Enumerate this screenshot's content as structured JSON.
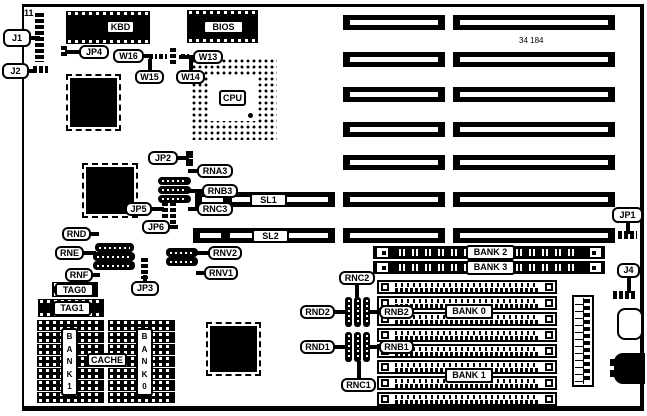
{
  "title": "motherboard jumper location diagram",
  "part_number": "34 184",
  "pin1_label": "11",
  "cpu_label": "CPU",
  "board": {
    "x": 22,
    "y": 4,
    "w": 622,
    "h": 407
  },
  "texts": [
    {
      "label": "11",
      "x": 24,
      "y": 8,
      "style": "bold"
    },
    {
      "label": "34 184",
      "x": 519,
      "y": 36,
      "style": "small"
    }
  ],
  "labels": [
    {
      "label": "KBD",
      "x": 106,
      "y": 20,
      "w": 29,
      "h": 14
    },
    {
      "label": "BIOS",
      "x": 203,
      "y": 20,
      "w": 41,
      "h": 14
    },
    {
      "label": "CPU",
      "x": 219,
      "y": 90,
      "w": 27,
      "h": 16
    },
    {
      "label": "SL1",
      "x": 250,
      "y": 193,
      "w": 37,
      "h": 14
    },
    {
      "label": "SL2",
      "x": 252,
      "y": 229,
      "w": 37,
      "h": 14
    },
    {
      "label": "TAG0",
      "x": 55,
      "y": 283,
      "w": 39,
      "h": 14
    },
    {
      "label": "TAG1",
      "x": 53,
      "y": 301,
      "w": 38,
      "h": 15
    },
    {
      "label": "CACHE",
      "x": 87,
      "y": 353,
      "w": 40,
      "h": 14
    },
    {
      "label": "BANK 2",
      "x": 466,
      "y": 245,
      "w": 49,
      "h": 15
    },
    {
      "label": "BANK 3",
      "x": 466,
      "y": 260,
      "w": 49,
      "h": 15
    },
    {
      "label": "BANK 0",
      "x": 445,
      "y": 304,
      "w": 48,
      "h": 15
    },
    {
      "label": "BANK 1",
      "x": 445,
      "y": 368,
      "w": 48,
      "h": 15
    }
  ],
  "vertical_labels": [
    {
      "label": "B\nA\nN\nK\n1",
      "x": 61,
      "y": 328,
      "w": 17,
      "h": 68
    },
    {
      "label": "B\nA\nN\nK\n0",
      "x": 136,
      "y": 328,
      "w": 17,
      "h": 68
    }
  ],
  "callouts": [
    {
      "label": "J1",
      "x": 3,
      "y": 29,
      "w": 28,
      "h": 18,
      "tail": "right",
      "len": 7
    },
    {
      "label": "J2",
      "x": 2,
      "y": 63,
      "w": 27,
      "h": 16,
      "tail": "right",
      "len": 6
    },
    {
      "label": "JP4",
      "x": 79,
      "y": 45,
      "w": 30,
      "h": 14,
      "tail": "left",
      "len": 12
    },
    {
      "label": "W16",
      "x": 113,
      "y": 49,
      "w": 31,
      "h": 14,
      "tail": "right",
      "len": 6
    },
    {
      "label": "W13",
      "x": 193,
      "y": 50,
      "w": 30,
      "h": 14,
      "tail": "left",
      "len": 12
    },
    {
      "label": "W15",
      "x": 135,
      "y": 70,
      "w": 29,
      "h": 14,
      "tail": "up",
      "len": 9
    },
    {
      "label": "W14",
      "x": 176,
      "y": 70,
      "w": 29,
      "h": 14,
      "tail": "up",
      "len": 9
    },
    {
      "label": "JP2",
      "x": 148,
      "y": 151,
      "w": 30,
      "h": 14,
      "tail": "right",
      "len": 9
    },
    {
      "label": "RNA3",
      "x": 197,
      "y": 164,
      "w": 36,
      "h": 14,
      "tail": "left",
      "len": 7
    },
    {
      "label": "RNB3",
      "x": 202,
      "y": 184,
      "w": 36,
      "h": 14,
      "tail": "left",
      "len": 11
    },
    {
      "label": "RNC3",
      "x": 197,
      "y": 202,
      "w": 36,
      "h": 14,
      "tail": "left",
      "len": 7
    },
    {
      "label": "JP5",
      "x": 125,
      "y": 202,
      "w": 27,
      "h": 14,
      "tail": "right",
      "len": 10
    },
    {
      "label": "JP6",
      "x": 142,
      "y": 220,
      "w": 28,
      "h": 14,
      "tail": "right",
      "len": 6
    },
    {
      "label": "RND",
      "x": 62,
      "y": 227,
      "w": 29,
      "h": 14,
      "tail": "right",
      "len": 6
    },
    {
      "label": "RNE",
      "x": 55,
      "y": 246,
      "w": 29,
      "h": 14,
      "tail": "right",
      "len": 10
    },
    {
      "label": "RNF",
      "x": 65,
      "y": 268,
      "w": 28,
      "h": 14,
      "tail": "right",
      "len": 5
    },
    {
      "label": "JP3",
      "x": 131,
      "y": 281,
      "w": 28,
      "h": 15,
      "tail": "up",
      "len": 4
    },
    {
      "label": "RNV2",
      "x": 208,
      "y": 246,
      "w": 34,
      "h": 14,
      "tail": "left",
      "len": 10
    },
    {
      "label": "RNV1",
      "x": 204,
      "y": 266,
      "w": 34,
      "h": 14,
      "tail": "left",
      "len": 6
    },
    {
      "label": "JP1",
      "x": 612,
      "y": 207,
      "w": 31,
      "h": 16,
      "tail": "down",
      "len": 9
    },
    {
      "label": "J4",
      "x": 617,
      "y": 263,
      "w": 23,
      "h": 15,
      "tail": "down",
      "len": 13
    },
    {
      "label": "RNC2",
      "x": 339,
      "y": 271,
      "w": 36,
      "h": 14,
      "tail": "down",
      "len": 13
    },
    {
      "label": "RND2",
      "x": 300,
      "y": 305,
      "w": 35,
      "h": 14,
      "tail": "right",
      "len": 11
    },
    {
      "label": "RNB2",
      "x": 379,
      "y": 305,
      "w": 35,
      "h": 14,
      "tail": "left",
      "len": 8
    },
    {
      "label": "RND1",
      "x": 300,
      "y": 340,
      "w": 35,
      "h": 14,
      "tail": "right",
      "len": 11
    },
    {
      "label": "RNB1",
      "x": 379,
      "y": 340,
      "w": 35,
      "h": 14,
      "tail": "left",
      "len": 8
    },
    {
      "label": "RNC1",
      "x": 341,
      "y": 378,
      "w": 35,
      "h": 14,
      "tail": "up",
      "len": 15
    }
  ],
  "isa_slots": [
    {
      "x": 343,
      "y": 15,
      "w": 102,
      "h": 15
    },
    {
      "x": 453,
      "y": 15,
      "w": 162,
      "h": 15
    },
    {
      "x": 343,
      "y": 52,
      "w": 102,
      "h": 15
    },
    {
      "x": 453,
      "y": 52,
      "w": 162,
      "h": 15
    },
    {
      "x": 343,
      "y": 87,
      "w": 102,
      "h": 15
    },
    {
      "x": 453,
      "y": 87,
      "w": 162,
      "h": 15
    },
    {
      "x": 343,
      "y": 122,
      "w": 102,
      "h": 15
    },
    {
      "x": 453,
      "y": 122,
      "w": 162,
      "h": 15
    },
    {
      "x": 343,
      "y": 155,
      "w": 102,
      "h": 15
    },
    {
      "x": 453,
      "y": 155,
      "w": 162,
      "h": 15
    },
    {
      "x": 343,
      "y": 192,
      "w": 102,
      "h": 15
    },
    {
      "x": 453,
      "y": 192,
      "w": 162,
      "h": 15
    },
    {
      "x": 343,
      "y": 228,
      "w": 102,
      "h": 15
    },
    {
      "x": 453,
      "y": 228,
      "w": 162,
      "h": 15
    }
  ],
  "sl_slots": [
    {
      "x": 195,
      "y": 192,
      "w": 140,
      "h": 15
    },
    {
      "x": 193,
      "y": 228,
      "w": 142,
      "h": 15
    }
  ],
  "simm_black_slots": [
    {
      "x": 373,
      "y": 246,
      "w": 232,
      "h": 13
    },
    {
      "x": 373,
      "y": 261,
      "w": 232,
      "h": 13
    }
  ],
  "simm_white_slots": {
    "x": 377,
    "w": 180,
    "h": 14,
    "rows": [
      280,
      296,
      312,
      328,
      344,
      360,
      376,
      392
    ]
  },
  "dip_chips": [
    {
      "x": 66,
      "y": 11,
      "w": 84,
      "h": 33
    },
    {
      "x": 187,
      "y": 10,
      "w": 71,
      "h": 33
    },
    {
      "x": 52,
      "y": 282,
      "w": 46,
      "h": 15
    },
    {
      "x": 38,
      "y": 299,
      "w": 66,
      "h": 18
    }
  ],
  "qfp_chips": [
    {
      "x": 67,
      "y": 75,
      "w": 53,
      "h": 55
    },
    {
      "x": 83,
      "y": 164,
      "w": 54,
      "h": 53
    },
    {
      "x": 207,
      "y": 323,
      "w": 53,
      "h": 52
    }
  ],
  "cache_banks": {
    "cols": [
      {
        "x": 37,
        "w": 67
      },
      {
        "x": 108,
        "w": 67
      }
    ],
    "rows": [
      320,
      332,
      344,
      356,
      368,
      380,
      392
    ],
    "h": 11
  },
  "cpu_socket": {
    "x": 190,
    "y": 57,
    "w": 87,
    "h": 83,
    "center": {
      "x": 210,
      "y": 76,
      "w": 46,
      "h": 45
    },
    "dot": {
      "x": 248,
      "y": 113,
      "w": 5,
      "h": 5
    }
  },
  "resnets_h": [
    {
      "x": 158,
      "y": 177,
      "w": 33,
      "h": 8
    },
    {
      "x": 158,
      "y": 186,
      "w": 33,
      "h": 8
    },
    {
      "x": 158,
      "y": 195,
      "w": 33,
      "h": 8
    },
    {
      "x": 95,
      "y": 243,
      "w": 39,
      "h": 9
    },
    {
      "x": 93,
      "y": 252,
      "w": 42,
      "h": 9
    },
    {
      "x": 93,
      "y": 261,
      "w": 42,
      "h": 9
    },
    {
      "x": 166,
      "y": 248,
      "w": 32,
      "h": 9
    },
    {
      "x": 166,
      "y": 257,
      "w": 32,
      "h": 9
    }
  ],
  "resnets_v": [
    {
      "x": 345,
      "y": 297,
      "w": 7,
      "h": 30
    },
    {
      "x": 354,
      "y": 297,
      "w": 7,
      "h": 30
    },
    {
      "x": 363,
      "y": 297,
      "w": 7,
      "h": 30
    },
    {
      "x": 345,
      "y": 332,
      "w": 7,
      "h": 30
    },
    {
      "x": 354,
      "y": 332,
      "w": 7,
      "h": 30
    },
    {
      "x": 363,
      "y": 332,
      "w": 7,
      "h": 30
    }
  ],
  "jumpers": [
    {
      "name": "j1-header",
      "x": 35,
      "y": 13,
      "w": 9,
      "h": 49,
      "kind": "vbar"
    },
    {
      "name": "j2-jumper",
      "x": 33,
      "y": 66,
      "w": 15,
      "h": 7,
      "kind": "hbar"
    },
    {
      "name": "jp4-jumper",
      "x": 61,
      "y": 46,
      "w": 6,
      "h": 11,
      "kind": "vbar"
    },
    {
      "name": "w16-jumper",
      "x": 149,
      "y": 54,
      "w": 8,
      "h": 5,
      "kind": "hbar"
    },
    {
      "name": "w15-jumper",
      "x": 159,
      "y": 54,
      "w": 8,
      "h": 5,
      "kind": "hbar"
    },
    {
      "name": "w-center-jumper",
      "x": 170,
      "y": 48,
      "w": 6,
      "h": 18,
      "kind": "vbar"
    },
    {
      "name": "w14-jumper",
      "x": 181,
      "y": 54,
      "w": 8,
      "h": 5,
      "kind": "hbar"
    },
    {
      "name": "jp2-jumper-a",
      "x": 186,
      "y": 151,
      "w": 7,
      "h": 7,
      "kind": "solid"
    },
    {
      "name": "jp2-jumper-b",
      "x": 186,
      "y": 159,
      "w": 7,
      "h": 7,
      "kind": "solid"
    },
    {
      "name": "jp5-jumper",
      "x": 162,
      "y": 202,
      "w": 6,
      "h": 16,
      "kind": "vbar"
    },
    {
      "name": "jp6-jumper",
      "x": 170,
      "y": 202,
      "w": 6,
      "h": 26,
      "kind": "vbar"
    },
    {
      "name": "jp3-jumper",
      "x": 141,
      "y": 258,
      "w": 7,
      "h": 21,
      "kind": "vbar"
    },
    {
      "name": "jp1-jumper",
      "x": 618,
      "y": 231,
      "w": 19,
      "h": 8,
      "kind": "hbar"
    },
    {
      "name": "j4-jumper",
      "x": 613,
      "y": 291,
      "w": 24,
      "h": 8,
      "kind": "hbar"
    }
  ],
  "connectors": [
    {
      "name": "power-header",
      "x": 572,
      "y": 295,
      "w": 22,
      "h": 92,
      "kind": "pinrow"
    },
    {
      "name": "battery-outline",
      "x": 617,
      "y": 308,
      "w": 26,
      "h": 32,
      "kind": "outline"
    },
    {
      "name": "din-keyboard-connector",
      "x": 614,
      "y": 353,
      "w": 31,
      "h": 31,
      "kind": "din"
    }
  ]
}
